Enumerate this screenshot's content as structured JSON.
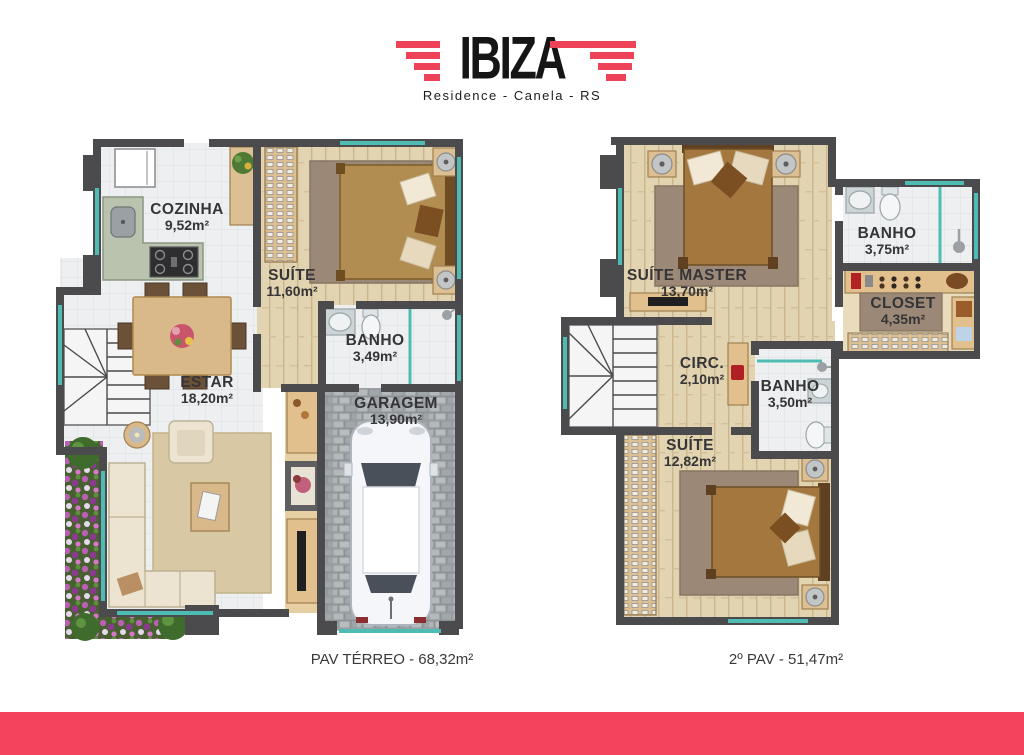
{
  "brand": {
    "title": "IBIZA",
    "subtitle": "Residence - Canela - RS",
    "accent_color": "#ee4258"
  },
  "plans": [
    {
      "id": "pav-terreo",
      "caption": "PAV TÉRREO - 68,32m²",
      "rooms": [
        {
          "name": "COZINHA",
          "area": "9,52m²"
        },
        {
          "name": "SUÍTE",
          "area": "11,60m²"
        },
        {
          "name": "BANHO",
          "area": "3,49m²"
        },
        {
          "name": "ESTAR",
          "area": "18,20m²"
        },
        {
          "name": "GARAGEM",
          "area": "13,90m²"
        }
      ]
    },
    {
      "id": "segundo-pav",
      "caption": "2º PAV - 51,47m²",
      "rooms": [
        {
          "name": "SUÍTE MASTER",
          "area": "13,70m²"
        },
        {
          "name": "BANHO",
          "area": "3,75m²"
        },
        {
          "name": "CLOSET",
          "area": "4,35m²"
        },
        {
          "name": "CIRC.",
          "area": "2,10m²"
        },
        {
          "name": "BANHO",
          "area": "3,50m²"
        },
        {
          "name": "SUÍTE",
          "area": "12,82m²"
        }
      ]
    }
  ],
  "palette": {
    "wall": "#4b4b4e",
    "window_glass": "#4fbcb4",
    "wood_floor": "#e2d3b1",
    "tile_floor": "#edeff0",
    "paver_floor": "#a9aeb2",
    "garden_flowers": "#b95fb4",
    "footer_band": "#f4435c"
  }
}
